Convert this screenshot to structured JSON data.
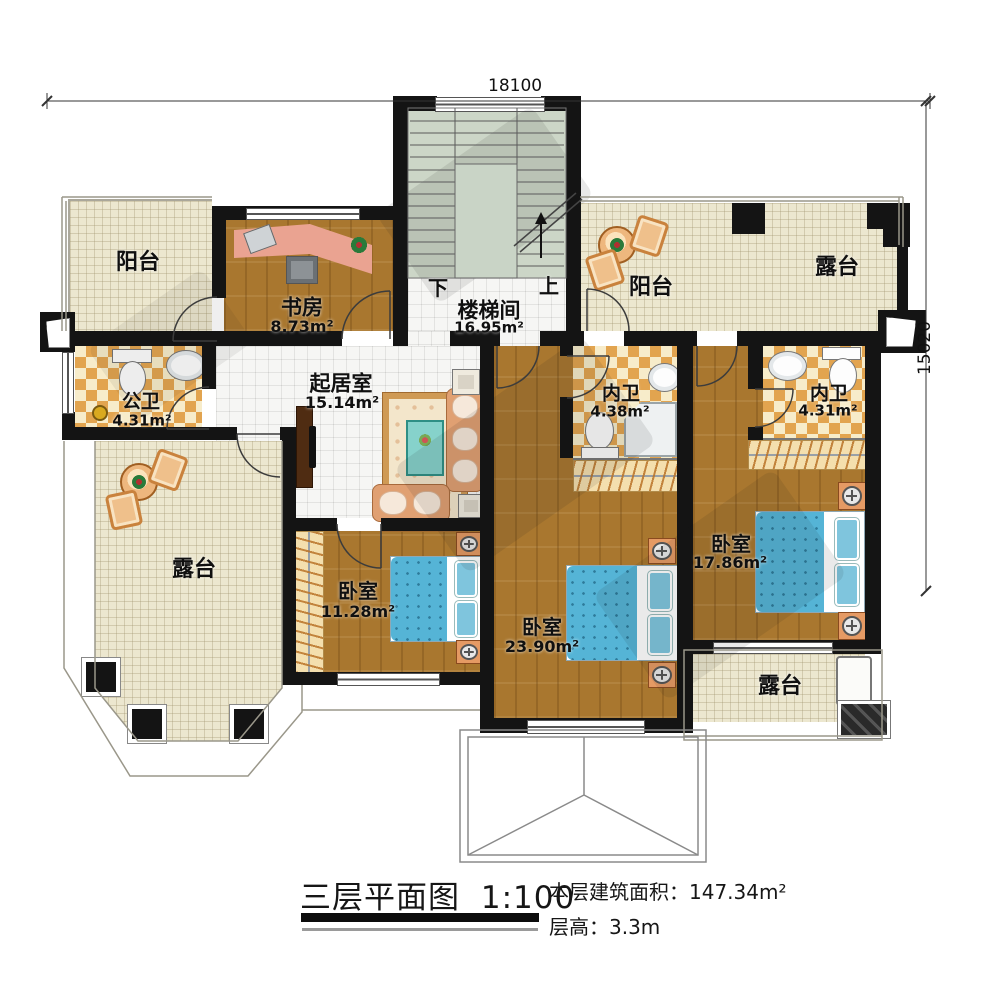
{
  "dimensions": {
    "top": "18100",
    "right": "15020"
  },
  "rooms": {
    "balcony_left": {
      "name": "阳台"
    },
    "study": {
      "name": "书房",
      "area": "8.73m²"
    },
    "stairwell": {
      "name": "楼梯间",
      "area": "16.95m²",
      "down_label": "下",
      "up_label": "上"
    },
    "balcony_right": {
      "name": "阳台"
    },
    "terrace_top_right": {
      "name": "露台"
    },
    "public_bath": {
      "name": "公卫",
      "area": "4.31m²"
    },
    "living_room": {
      "name": "起居室",
      "area": "15.14m²"
    },
    "ensuite_bath_left": {
      "name": "内卫",
      "area": "4.38m²"
    },
    "ensuite_bath_right": {
      "name": "内卫",
      "area": "4.31m²"
    },
    "terrace_left": {
      "name": "露台"
    },
    "bedroom_small": {
      "name": "卧室",
      "area": "11.28m²"
    },
    "bedroom_large": {
      "name": "卧室",
      "area": "23.90m²"
    },
    "bedroom_right": {
      "name": "卧室",
      "area": "17.86m²"
    },
    "terrace_bottom_right": {
      "name": "露台"
    }
  },
  "title_block": {
    "title": "三层平面图",
    "scale": "1:100",
    "floor_area_label": "本层建筑面积：",
    "floor_area_value": "147.34m²",
    "floor_height_label": "层高：",
    "floor_height_value": "3.3m"
  },
  "colors": {
    "wall": "#141414",
    "wood_floor": "#a9772f",
    "tile_cream": "#ece7cf",
    "tile_white": "#f6f6f4",
    "checker_orange": "#e2a44f",
    "stair_green": "#ccd6c7",
    "bed_blue": "#55b4d6",
    "furniture_tan": "#e0a072"
  }
}
